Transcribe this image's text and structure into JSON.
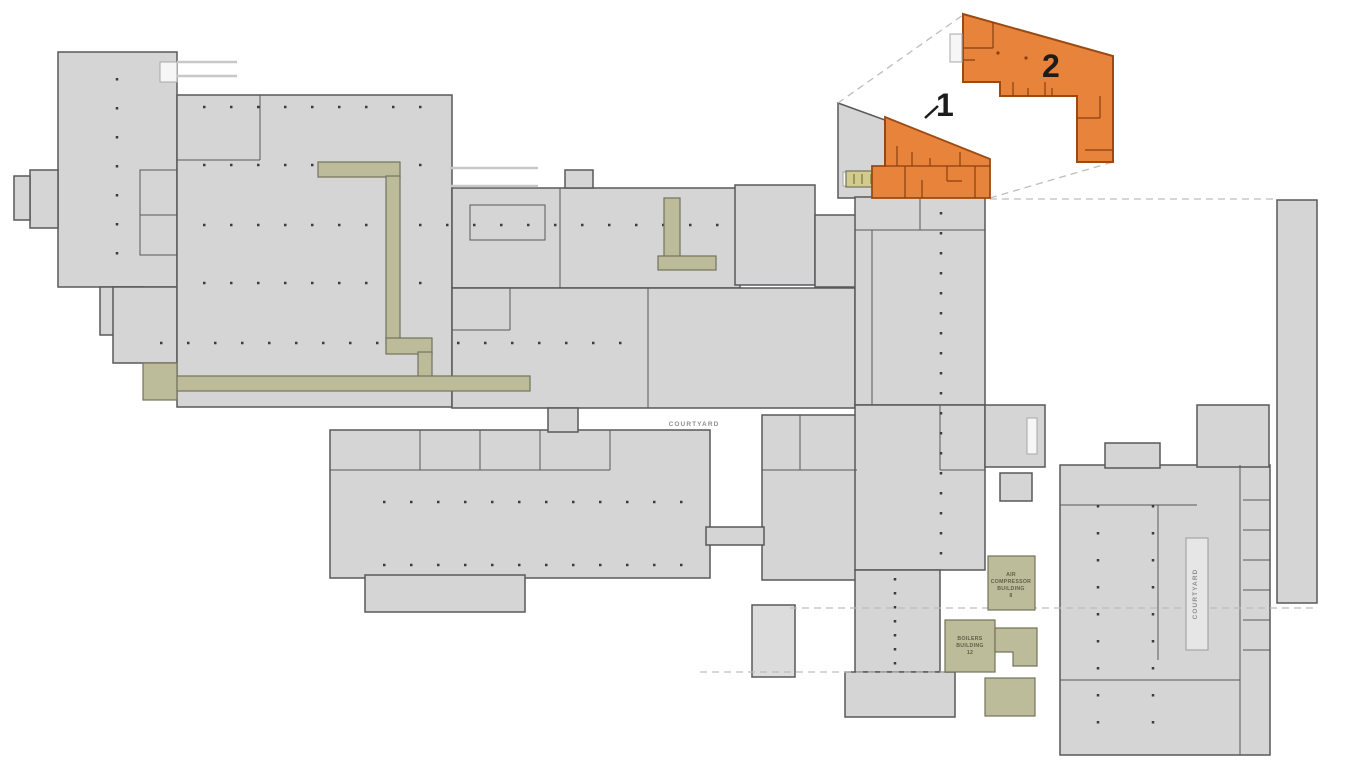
{
  "page": {
    "title": "Facility site floor plan with highlighted areas 1 and 2"
  },
  "colors": {
    "background": "#ffffff",
    "building_fill": "#d5d5d6",
    "building_fill_light": "#dcdcdc",
    "building_stroke": "#59595b",
    "opening_fill": "#f6f6f6",
    "opening_stroke": "#a8a8a8",
    "column_dot": "#3c3c3c",
    "dock_line": "#c8c8c8",
    "dashed_line": "#bdbdbd",
    "olive_fill": "#bdbc9a",
    "olive_bright_fill": "#d2cb8e",
    "olive_stroke": "#73735c",
    "olive_tick": "#7a7340",
    "courtyard_fill": "#e6e6e6",
    "courtyard_stroke": "#9a9a9a",
    "highlight_fill": "#e8833b",
    "highlight_stroke": "#9c4a12",
    "highlight_wall": "#8a3f0e",
    "annotation_color": "#1c1c1c",
    "map_label_color": "#8f8f8f",
    "building_label_color": "#5f5f49"
  },
  "annotations": {
    "area1_label": "1",
    "area2_label": "2"
  },
  "map_labels": {
    "courtyard_main": "COURTYARD",
    "courtyard_right": "COURTYARD"
  },
  "buildings": {
    "air_compressor": {
      "line1": "AIR",
      "line2": "COMPRESSOR",
      "line3": "BUILDING",
      "line4": "8"
    },
    "boilers": {
      "line1": "BOILERS",
      "line2": "BUILDING",
      "line3": "12"
    }
  }
}
